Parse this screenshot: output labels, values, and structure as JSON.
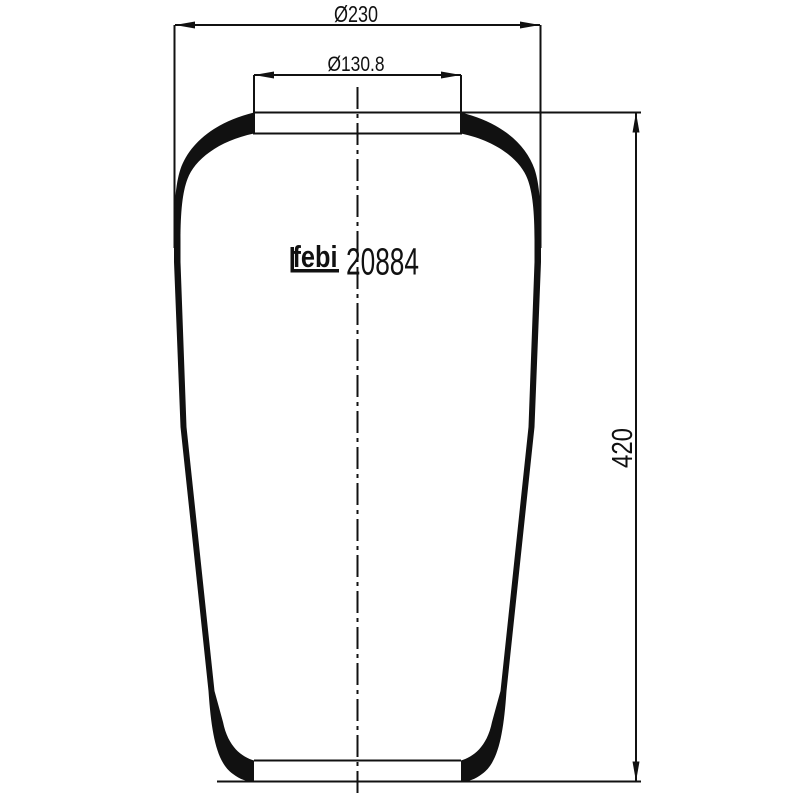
{
  "colors": {
    "line": "#111111",
    "background": "#ffffff"
  },
  "drawing": {
    "brand_logo": "febi",
    "part_number": "20884",
    "dimensions": {
      "outer_diameter": "Ø230",
      "neck_diameter": "Ø130.8",
      "height": "420"
    }
  }
}
